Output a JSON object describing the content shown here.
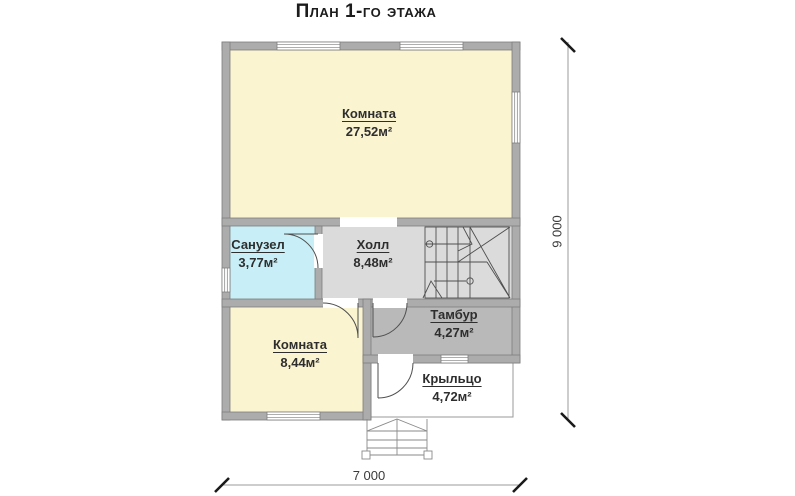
{
  "title": "План 1-го этажа",
  "rooms": [
    {
      "name": "Комната",
      "area": "27,52м²"
    },
    {
      "name": "Санузел",
      "area": "3,77м²"
    },
    {
      "name": "Холл",
      "area": "8,48м²"
    },
    {
      "name": "Тамбур",
      "area": "4,27м²"
    },
    {
      "name": "Комната",
      "area": "8,44м²"
    },
    {
      "name": "Крыльцо",
      "area": "4,72м²"
    }
  ],
  "dimensions": {
    "height": "9 000",
    "width": "7 000"
  },
  "colors": {
    "wall_fill": "#ACACAC",
    "wall_outline": "#7E7E7E",
    "room_yellow": "#FAF4D1",
    "bathroom_cyan": "#C8EFF7",
    "hall_gray": "#DBDBDB",
    "tambur_gray": "#B9B9B9",
    "line_dark": "#4F4F4F",
    "dim_line": "#9B9B9B",
    "tick_black": "#1A1A1A",
    "text": "#2E2E2E"
  }
}
